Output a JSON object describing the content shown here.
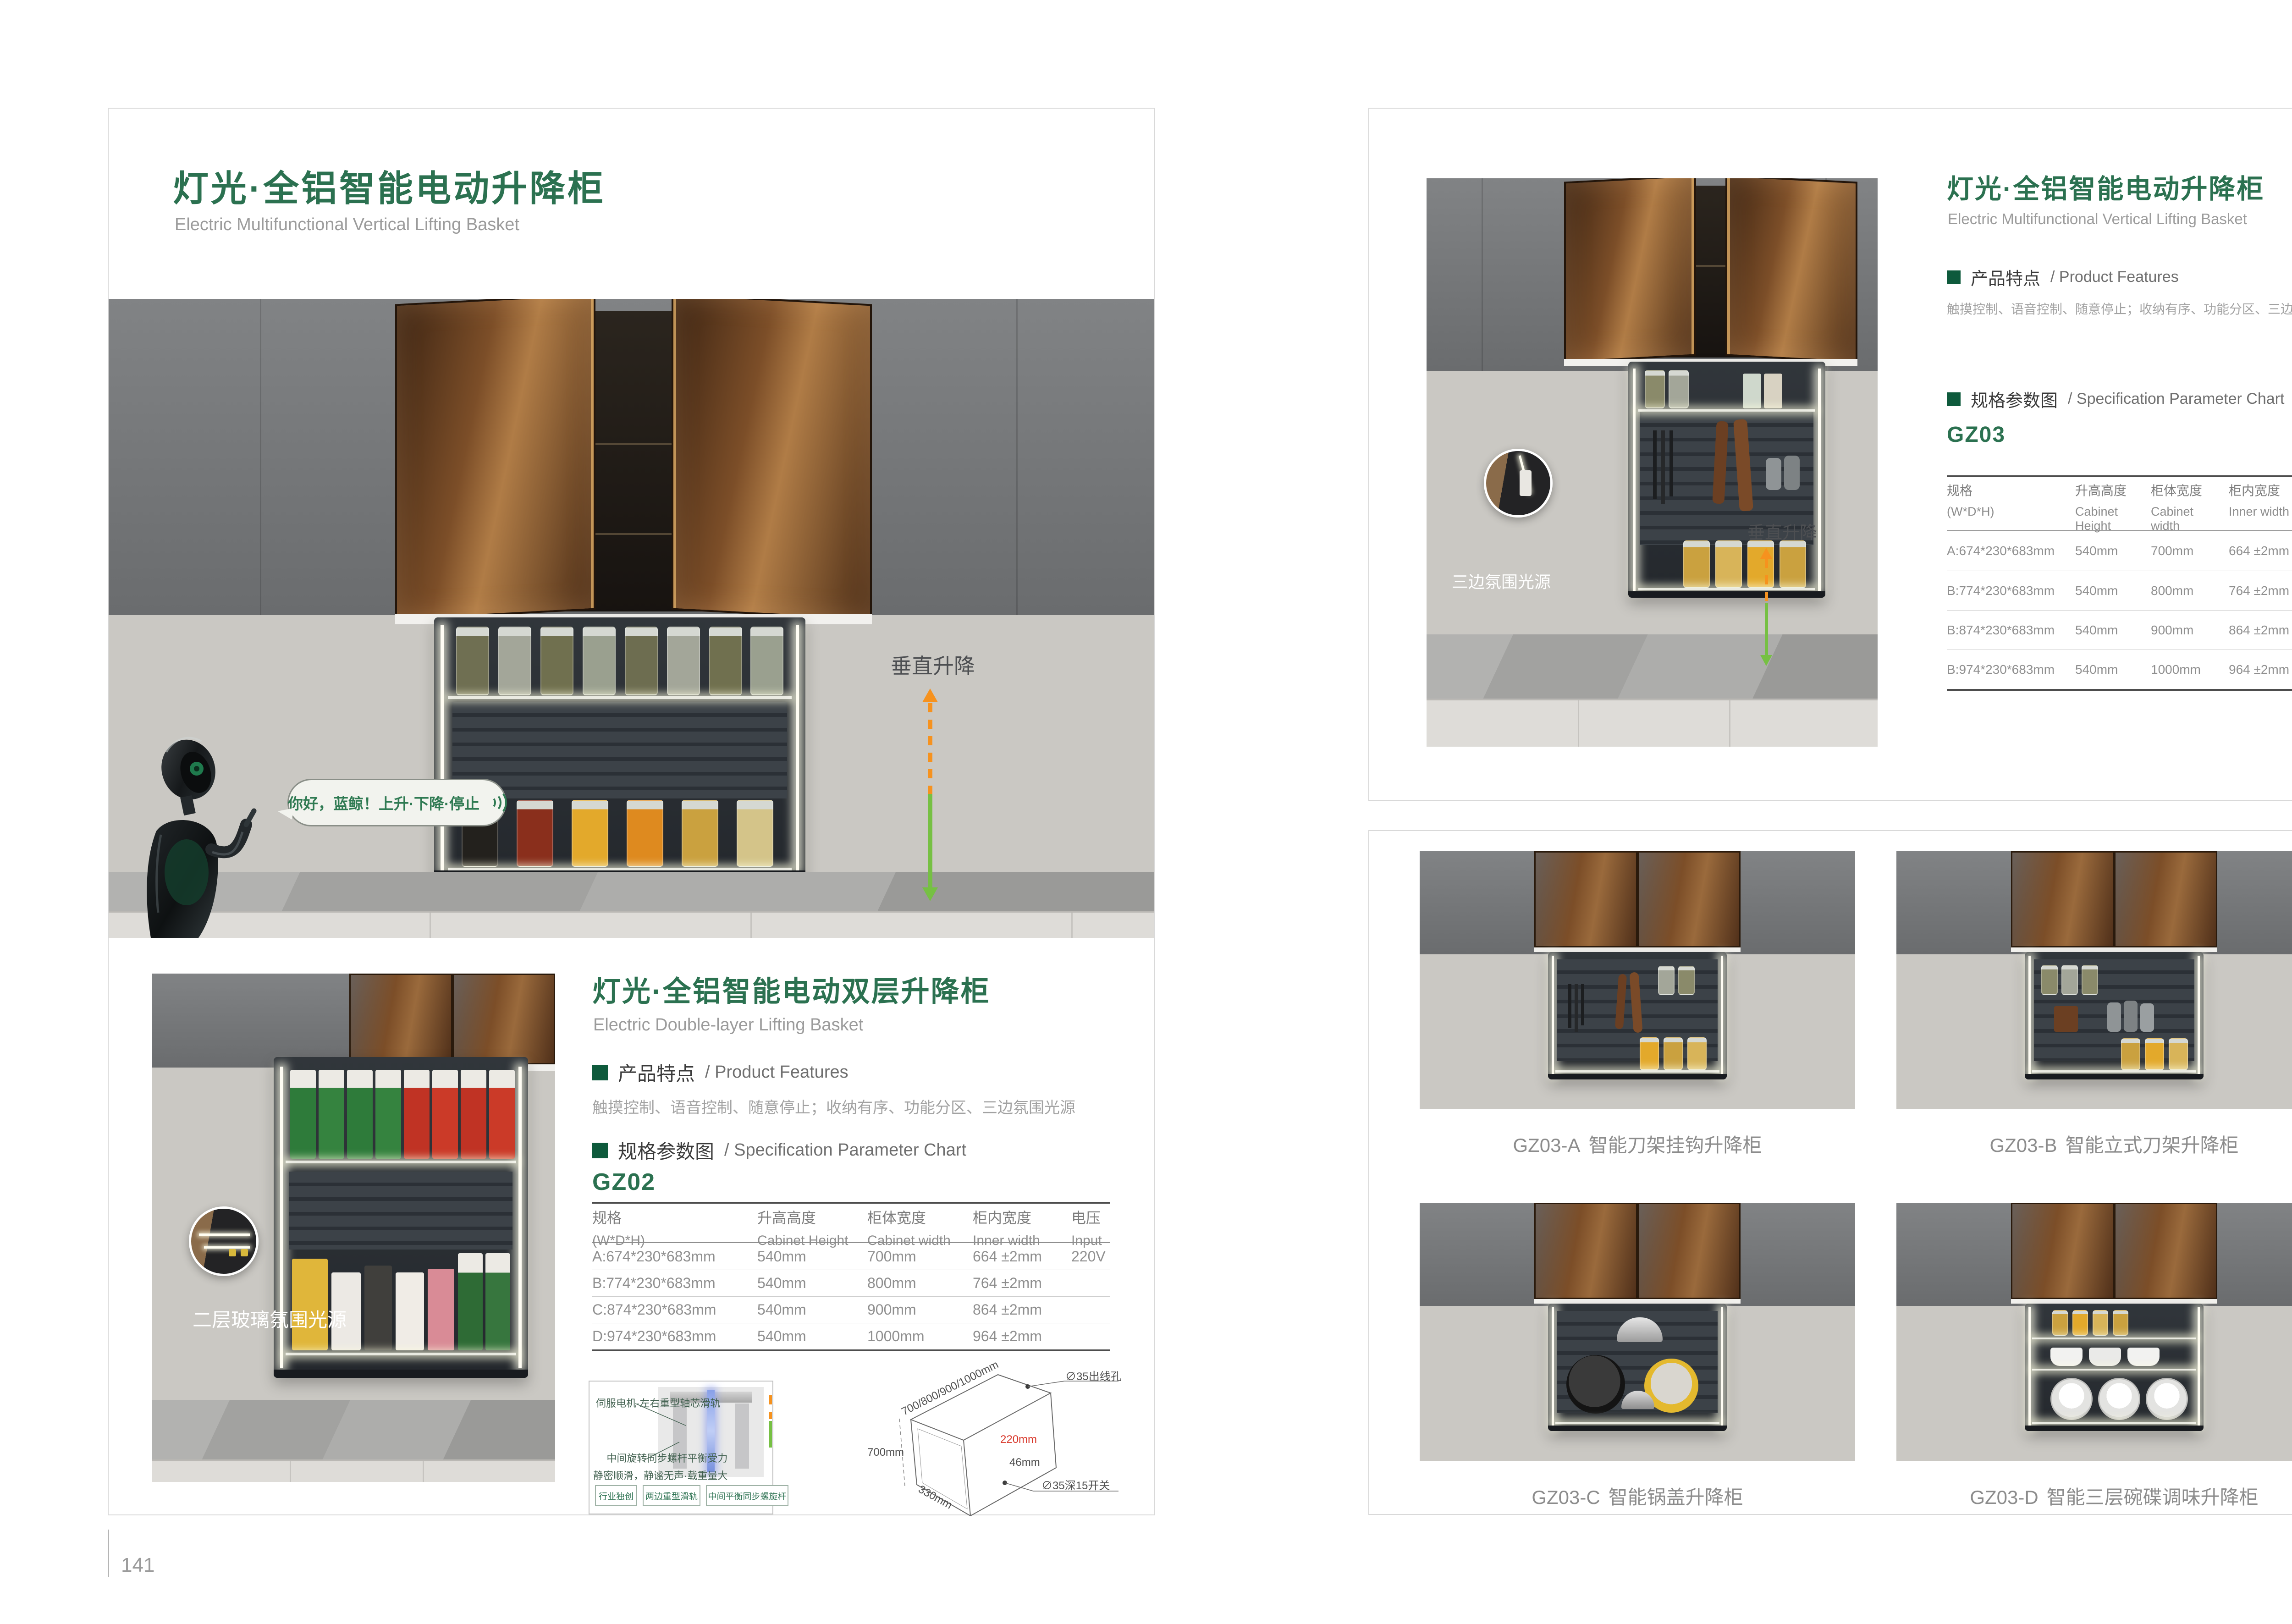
{
  "colors": {
    "brand_green": "#2B7150",
    "section_green": "#0E5A3C",
    "accent_orange": "#F6921E",
    "accent_green": "#76C043",
    "dim_red": "#D8372A"
  },
  "document": {
    "left_page": {
      "page_number": "141",
      "title_cn": "灯光·全铝智能电动升降柜",
      "title_en": "Electric Multifunctional Vertical Lifting Basket",
      "hero": {
        "speech_text": "你好，蓝鲸！上升·下降·停止",
        "lift_label": "垂直升降"
      },
      "double_layer": {
        "photo_label": "二层玻璃氛围光源",
        "title_cn": "灯光·全铝智能电动双层升降柜",
        "title_en": "Electric Double-layer Lifting Basket",
        "features_heading_cn": "产品特点",
        "features_heading_en": "/ Product Features",
        "features_text": "触摸控制、语音控制、随意停止；收纳有序、功能分区、三边氛围光源",
        "spec_heading_cn": "规格参数图",
        "spec_heading_en": "/ Specification Parameter Chart",
        "model": "GZ02",
        "table": {
          "col1_cn": "规格",
          "col1_en": "(W*D*H)",
          "col2_cn": "升高高度",
          "col2_en": "Cabinet Height",
          "col3_cn": "柜体宽度",
          "col3_en": "Cabinet width",
          "col4_cn": "柜内宽度",
          "col4_en": "Inner width",
          "col5_cn": "电压",
          "col5_en": "Input",
          "rows": [
            [
              "A:674*230*683mm",
              "540mm",
              "700mm",
              "664 ±2mm",
              "220V"
            ],
            [
              "B:774*230*683mm",
              "540mm",
              "800mm",
              "764 ±2mm",
              ""
            ],
            [
              "C:874*230*683mm",
              "540mm",
              "900mm",
              "864 ±2mm",
              ""
            ],
            [
              "D:974*230*683mm",
              "540mm",
              "1000mm",
              "964 ±2mm",
              ""
            ]
          ]
        },
        "mechanism": {
          "callout_top": "伺服电机·左右重型轴芯滑轨",
          "callout_bottom_1": "中间旋转同步螺杆平衡受力",
          "callout_bottom_2": "静密顺滑，静谧无声·载重量大",
          "chip_1": "行业独创",
          "chip_2": "两边重型滑轨",
          "chip_3": "中间平衡同步螺旋杆"
        },
        "diagram": {
          "width_range": "700/800/900/1000mm",
          "outlet_hole": "∅35出线孔",
          "height": "700mm",
          "inner_depth": "220mm",
          "offset": "46mm",
          "switch": "∅35深15开关",
          "depth": "330mm"
        }
      }
    },
    "right_page": {
      "page_number": "142",
      "title_cn": "灯光·全铝智能电动升降柜",
      "title_en": "Electric Multifunctional Vertical Lifting Basket",
      "features_heading_cn": "产品特点",
      "features_heading_en": "/ Product Features",
      "features_text": "触摸控制、语音控制、随意停止；收纳有序、功能分区、三边氛围光源",
      "spec_heading_cn": "规格参数图",
      "spec_heading_en": "/ Specification Parameter Chart",
      "model": "GZ03",
      "photo_label": "三边氛围光源",
      "lift_label": "垂直升降",
      "table": {
        "col1_cn": "规格",
        "col1_en": "(W*D*H)",
        "col2_cn": "升高高度",
        "col2_en": "Cabinet Height",
        "col3_cn": "柜体宽度",
        "col3_en": "Cabinet width",
        "col4_cn": "柜内宽度",
        "col4_en": "Inner width",
        "col5_cn": "电压",
        "col5_en": "Input",
        "rows": [
          [
            "A:674*230*683mm",
            "540mm",
            "700mm",
            "664 ±2mm",
            "220V"
          ],
          [
            "B:774*230*683mm",
            "540mm",
            "800mm",
            "764 ±2mm",
            ""
          ],
          [
            "B:874*230*683mm",
            "540mm",
            "900mm",
            "864 ±2mm",
            ""
          ],
          [
            "B:974*230*683mm",
            "540mm",
            "1000mm",
            "964 ±2mm",
            ""
          ]
        ]
      },
      "variants": [
        {
          "code": "GZ03-A",
          "name": "智能刀架挂钩升降柜"
        },
        {
          "code": "GZ03-B",
          "name": "智能立式刀架升降柜"
        },
        {
          "code": "GZ03-C",
          "name": "智能锅盖升降柜"
        },
        {
          "code": "GZ03-D",
          "name": "智能三层碗碟调味升降柜"
        }
      ]
    }
  }
}
